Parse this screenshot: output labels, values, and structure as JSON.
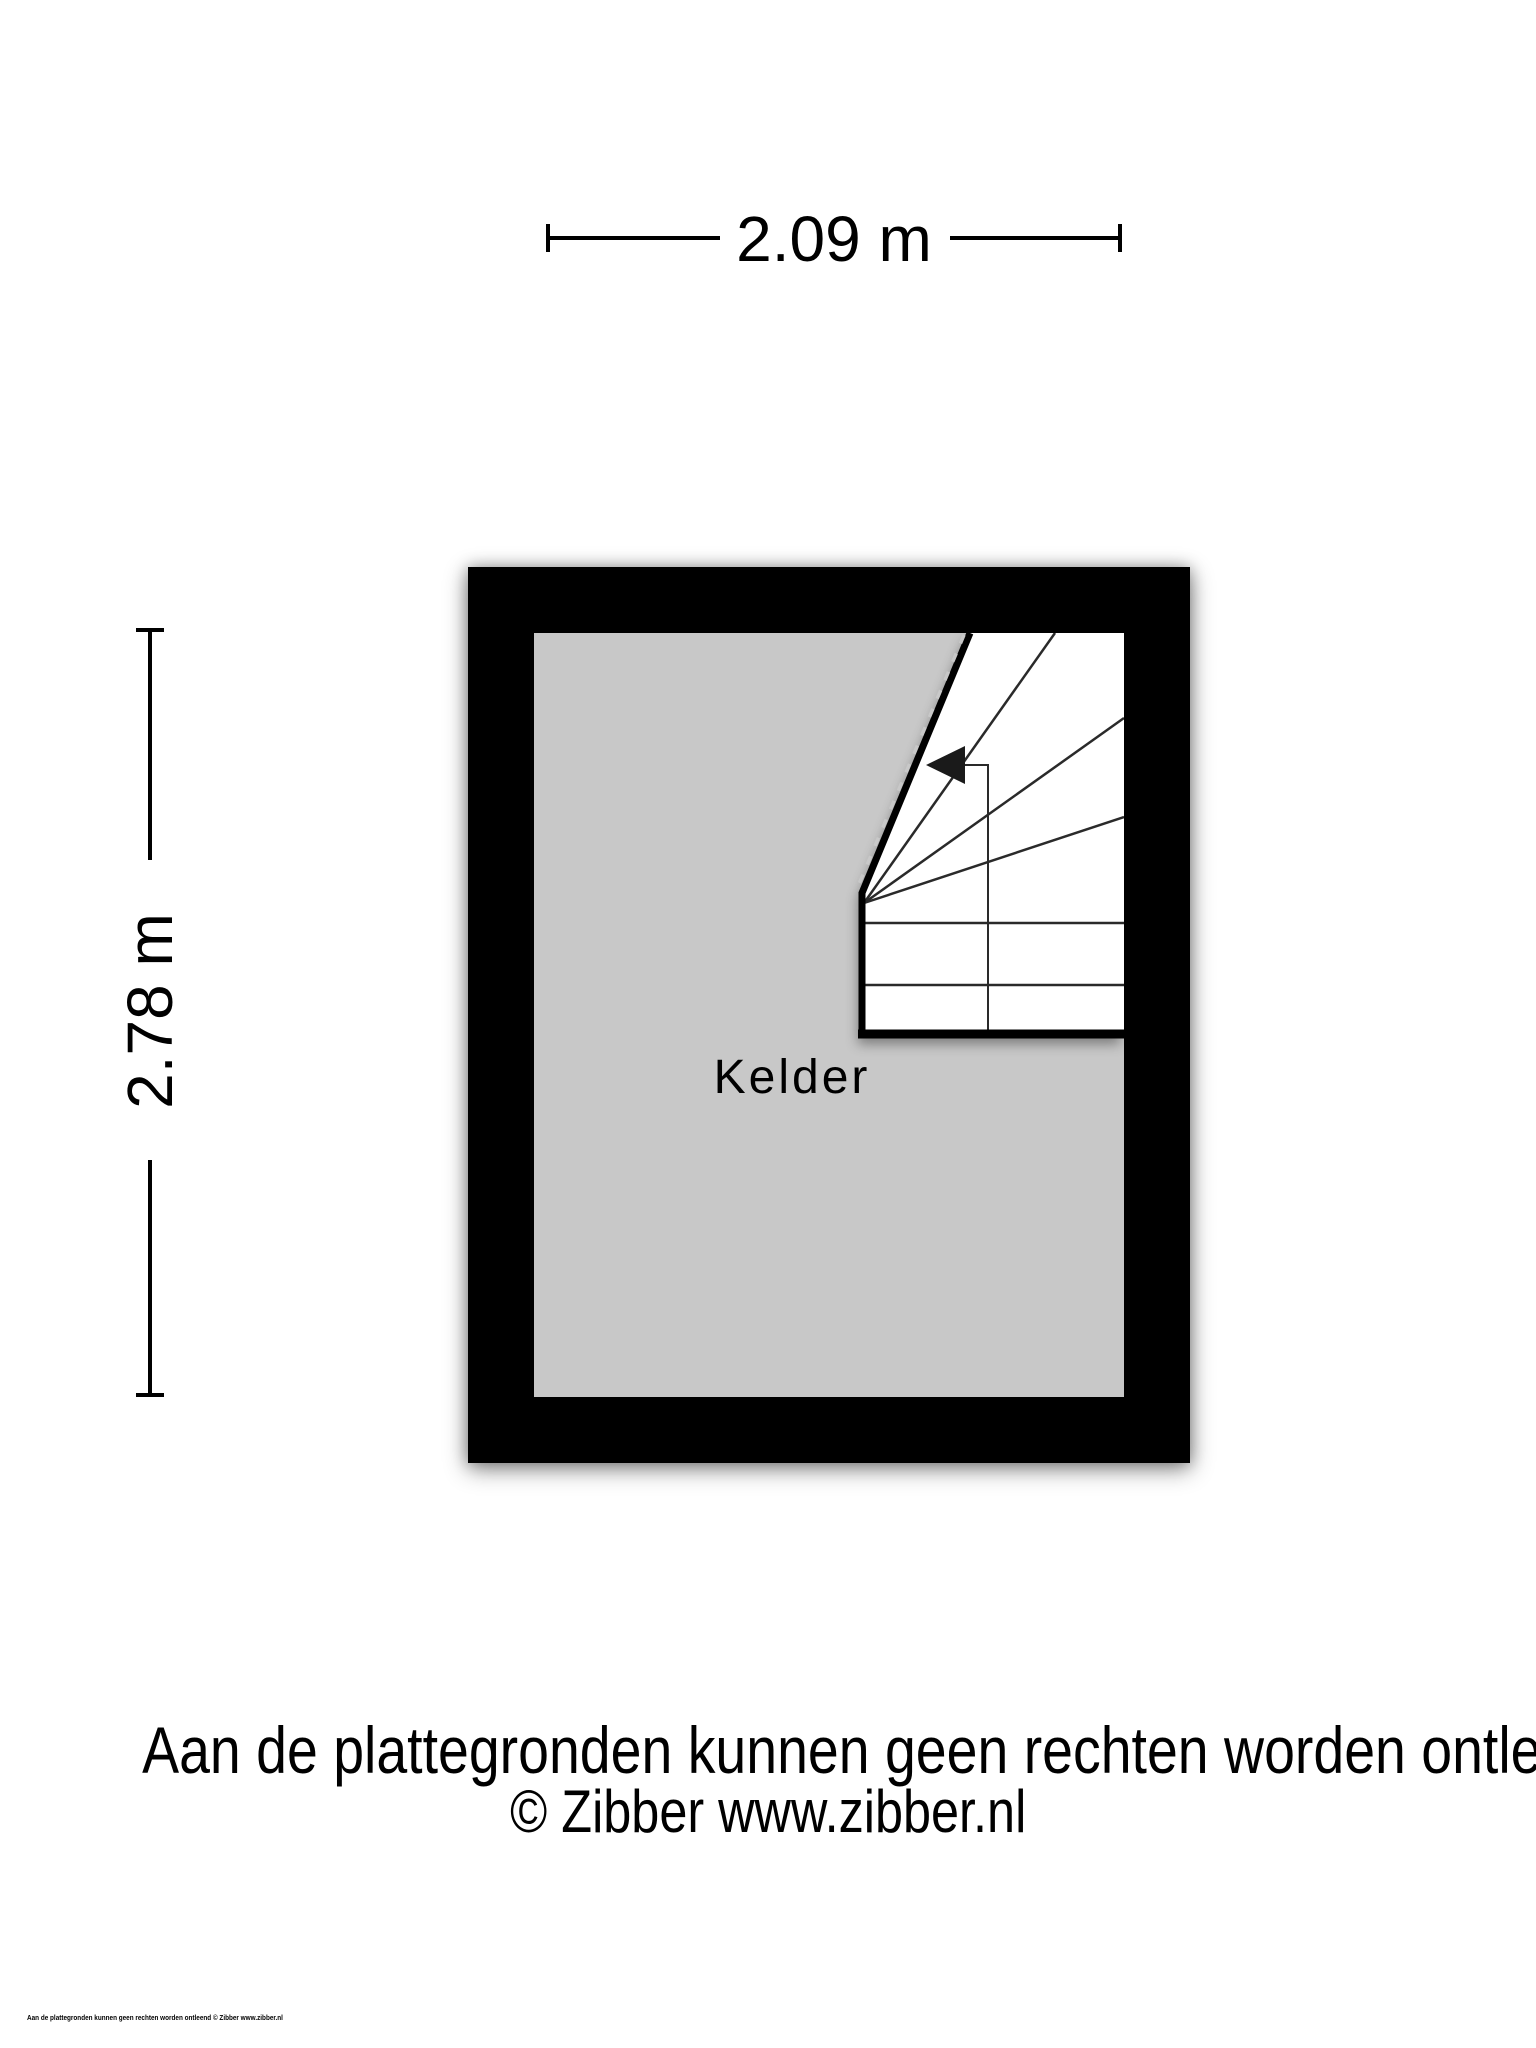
{
  "plan": {
    "room_label": "Kelder",
    "feature": "staircase"
  },
  "dimensions": {
    "width_label": "2.09 m",
    "height_label": "2.78 m"
  },
  "footer": {
    "disclaimer": "Aan de plattegronden kunnen geen rechten worden ontleend",
    "credit": "© Zibber www.zibber.nl"
  },
  "fine_print": "Aan de plattegronden kunnen geen rechten worden ontleend © Zibber www.zibber.nl",
  "colors": {
    "background": "#ffffff",
    "wall": "#000000",
    "floor": "#c8c8c8",
    "stairs": "#ffffff",
    "text": "#000000"
  }
}
